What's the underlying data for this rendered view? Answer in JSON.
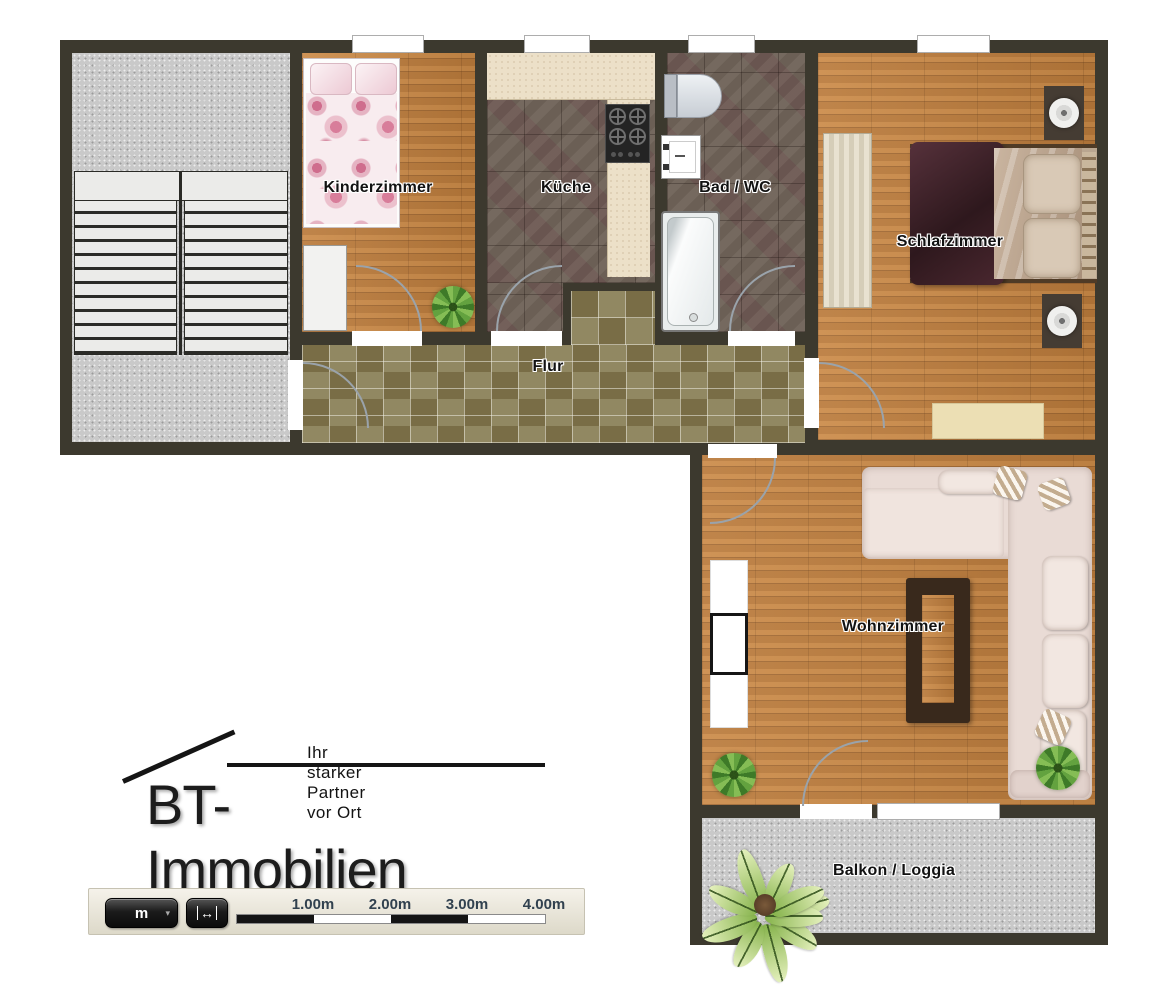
{
  "floorplan": {
    "rooms": [
      {
        "id": "kinderzimmer",
        "label": "Kinderzimmer"
      },
      {
        "id": "kueche",
        "label": "Küche"
      },
      {
        "id": "bad_wc",
        "label": "Bad / WC"
      },
      {
        "id": "schlafzimmer",
        "label": "Schlafzimmer"
      },
      {
        "id": "flur",
        "label": "Flur"
      },
      {
        "id": "wohnzimmer",
        "label": "Wohnzimmer"
      },
      {
        "id": "balkon_loggia",
        "label": "Balkon / Loggia"
      }
    ]
  },
  "logo": {
    "brand": "BT-Immobilien",
    "tagline": "Ihr starker Partner vor Ort"
  },
  "scalebar": {
    "unit": "m",
    "caret": "▾",
    "measure_icon": "↔",
    "ticks": [
      "1.00m",
      "2.00m",
      "3.00m",
      "4.00m"
    ]
  },
  "colors": {
    "wall": "#3c392e",
    "wood": "#c4813e",
    "tile_dark": "#6b5f55",
    "tile_olive": "#857a50",
    "concrete": "#c9c9c9",
    "counter": "#ece0c8",
    "arc": "#9aa3ab",
    "scale_label": "#31414f"
  }
}
